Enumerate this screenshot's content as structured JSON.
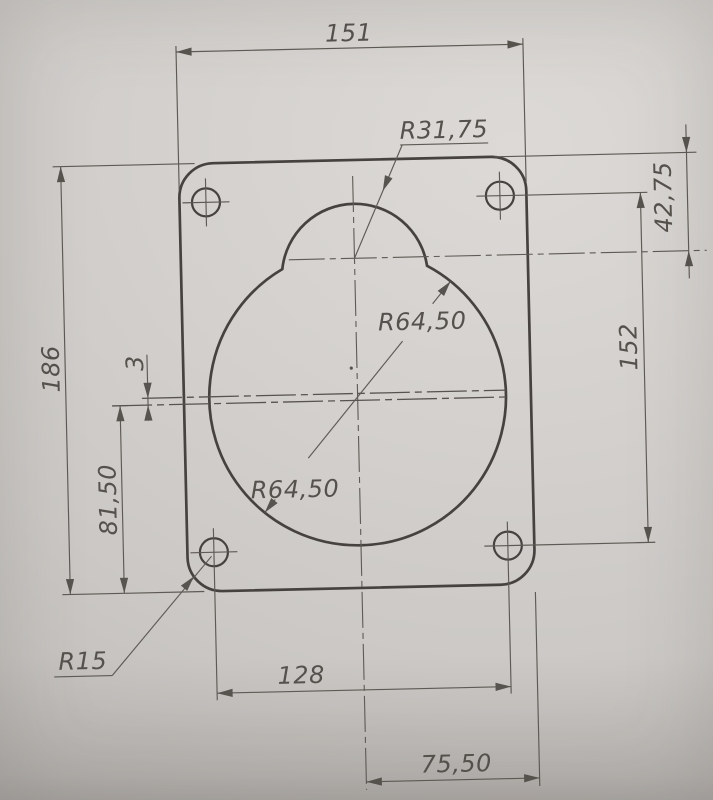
{
  "drawing": {
    "dimensions": {
      "plate_width": "151",
      "plate_height": "186",
      "arc_center_from_top": "42,75",
      "hole_spacing_vertical": "152",
      "slot_width": "3",
      "slot_from_bottom": "81,50",
      "hole_spacing_horizontal": "128",
      "center_to_right_edge": "75,50"
    },
    "radii": {
      "top_arc": "R31,75",
      "main_circle_upper": "R64,50",
      "main_circle_lower": "R64,50",
      "corner": "R15"
    },
    "colors": {
      "paper": "#d1cecb",
      "outline": "#454240",
      "dimension_lines": "#5e5a55",
      "text": "#55524d"
    }
  }
}
